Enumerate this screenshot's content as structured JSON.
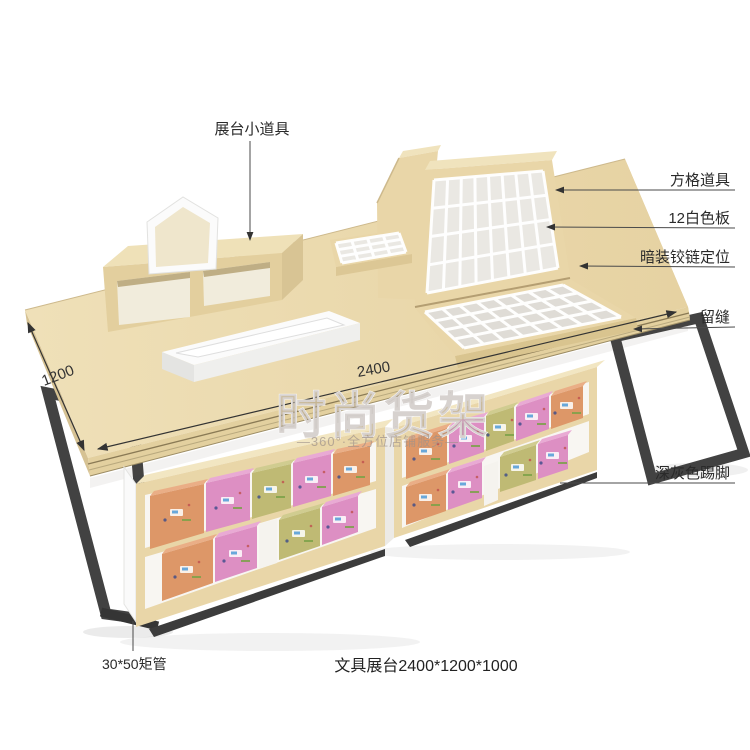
{
  "caption": "文具展台2400*1200*1000",
  "annotations": {
    "prop_top": "展台小道具",
    "right": [
      {
        "label": "方格道具"
      },
      {
        "label": "12白色板"
      },
      {
        "label": "暗装铰链定位"
      },
      {
        "label": "留缝"
      },
      {
        "label": "深灰色踢脚"
      }
    ],
    "bottom_left": "30*50矩管"
  },
  "dimensions": {
    "depth": "1200",
    "width": "2400"
  },
  "watermark": {
    "main": "时尚货架",
    "sub": "—360°·全方位店铺服务—"
  },
  "colors": {
    "wood": "#e9d6a8",
    "wood_front": "#e3cf9e",
    "wood_dark": "#d9c48f",
    "wood_light": "#f0e3bd",
    "white_panel": "#fafafa",
    "interior": "#f8f6f2",
    "grid_cell": "#eae8e3",
    "metal": "#424242",
    "kick": "#3c3c3c",
    "box_orange": "#dd9768",
    "box_orange_top": "#eaae86",
    "box_pink": "#dd8fc3",
    "box_pink_top": "#e9aad4",
    "box_olive": "#bfba74",
    "box_olive_top": "#d0cc90"
  }
}
